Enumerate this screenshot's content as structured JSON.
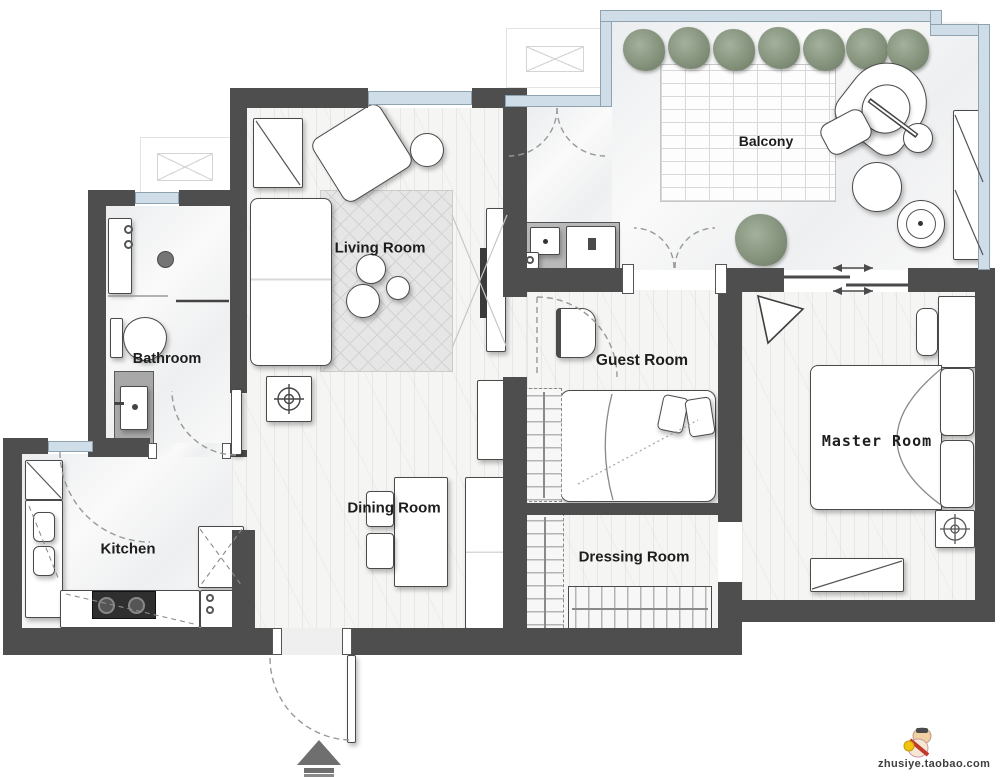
{
  "page": {
    "title": "Apartment Floor Plan"
  },
  "rooms": {
    "living": {
      "label": "Living Room"
    },
    "dining": {
      "label": "Dining Room"
    },
    "kitchen": {
      "label": "Kitchen"
    },
    "bathroom": {
      "label": "Bathroom"
    },
    "guest": {
      "label": "Guest Room"
    },
    "master": {
      "label": "Master Room"
    },
    "dressing": {
      "label": "Dressing Room"
    },
    "balcony": {
      "label": "Balcony"
    }
  },
  "watermark": {
    "site": "zhusiye.taobao.com"
  },
  "colors": {
    "wall": "#4e4e4e",
    "glass": "#cfdde9",
    "floor_wood": "#f5f5f3",
    "floor_stone": "#fafafa",
    "rug": "#e6e6e6",
    "plant": "#8b998a",
    "label": "#1d1d1d"
  },
  "legend": {
    "living": [
      "sofa",
      "lounge-chair",
      "side-table",
      "coffee-table-set",
      "area-rug",
      "tv-console",
      "round-fan",
      "side-cabinet"
    ],
    "balcony": [
      "hedge-plants-x7",
      "deck-rug",
      "hanging-egg-chair",
      "ottoman",
      "round-table",
      "planter",
      "storage-cabinet",
      "laundry-counter",
      "washing-machine",
      "utility-sink",
      "potted-plant"
    ],
    "bathroom": [
      "shower-set",
      "toilet",
      "vanity-sink"
    ],
    "kitchen": [
      "corner-cabinet",
      "double-sink-counter",
      "cooktop-counter",
      "pantry-cabinet",
      "refrigerator"
    ],
    "dining": [
      "dining-table",
      "dining-chairs-x2",
      "tall-cabinet",
      "sideboard-cabinet"
    ],
    "guest": [
      "desk-chair",
      "single-bed",
      "wardrobe"
    ],
    "master": [
      "double-bed",
      "pillows",
      "nightstand",
      "table-lamp",
      "accent-chair",
      "bench",
      "ac-unit"
    ],
    "dressing": [
      "wardrobe-left",
      "wardrobe-bottom"
    ],
    "entry": [
      "entry-door",
      "door-swing"
    ],
    "outdoor": [
      "ac-outdoor-unit-x2"
    ],
    "compass": "entrance-arrow"
  }
}
